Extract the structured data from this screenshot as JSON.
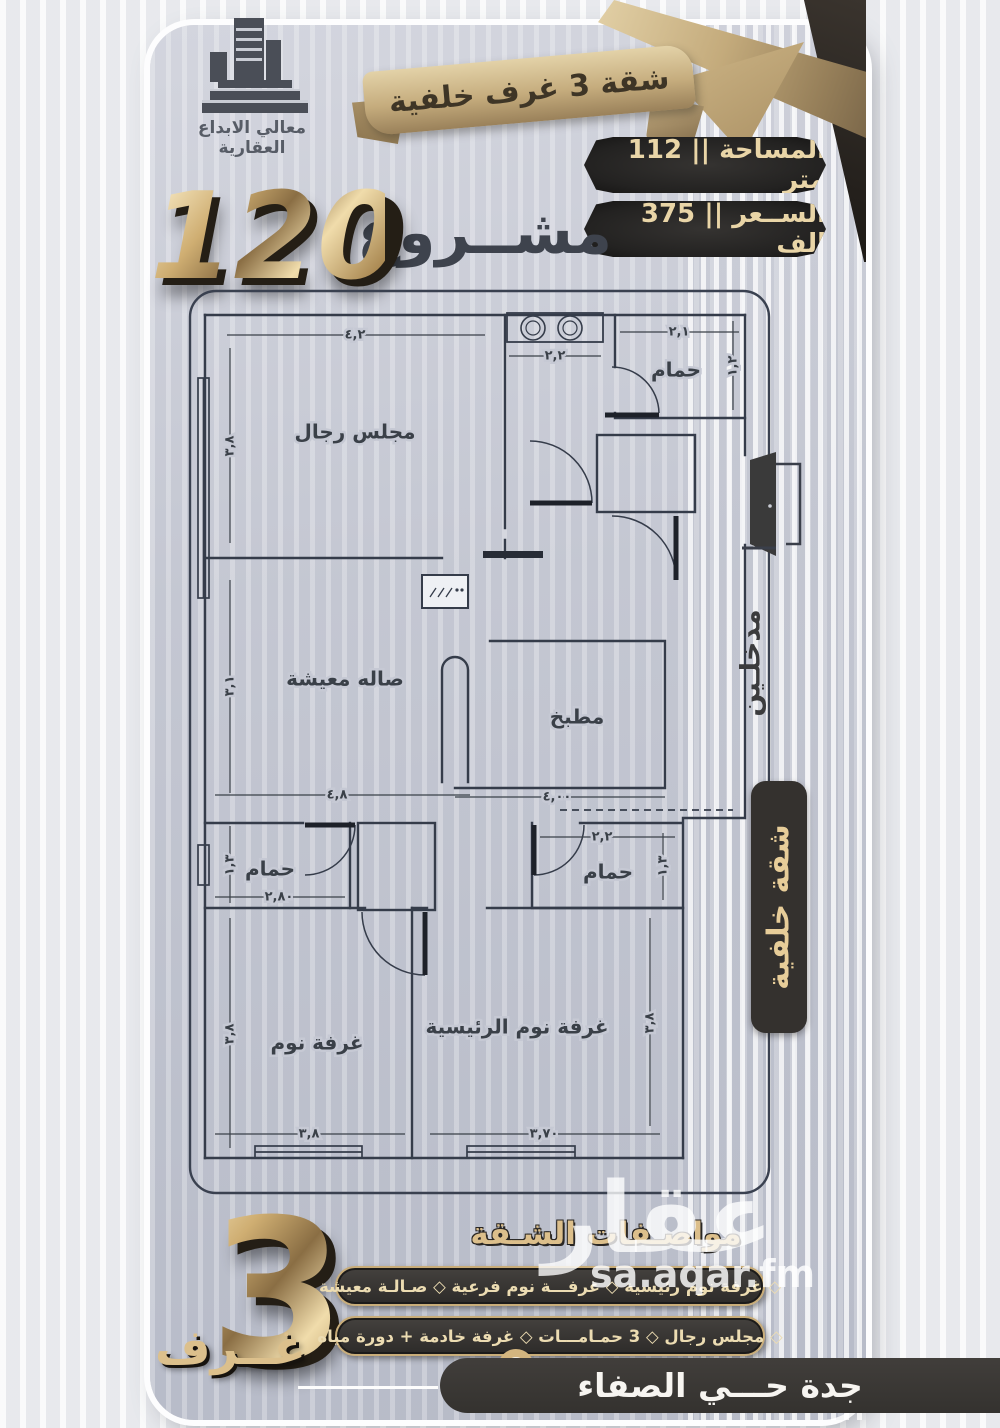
{
  "company": {
    "name": "معالي الابداع العقارية"
  },
  "ribbon": {
    "text": "شقة 3 غرف خلفية"
  },
  "stats": {
    "area": "المساحة || 112 متر",
    "price": "الســعر || 375 الف"
  },
  "project": {
    "word": "مشــروع",
    "number": "120"
  },
  "plan": {
    "rooms": {
      "majlis": "مجلس رجال",
      "bath_top": "حمام",
      "living": "صاله معيشة",
      "kitchen": "مطبخ",
      "bath_left": "حمام",
      "bath_right": "حمام",
      "bedroom": "غرفة نوم",
      "master": "غرفة نوم الرئيسية"
    },
    "dims": {
      "majlis_top": "٤,٢",
      "majlis_side": "٣,٨",
      "basin": "٢,٢",
      "bath_top_w": "٢,١",
      "bath_top_h": "١,٢",
      "living_side": "٣,١",
      "living_bottom": "٤,٨",
      "kitchen_bottom": "٤,٠٠",
      "bath_left_side": "١,٣",
      "bath_left_bottom": "٢,٨٠",
      "bath_right_top": "٢,٢",
      "bath_right_side": "١,٣",
      "bedroom_side": "٣,٨",
      "bedroom_bottom": "٣,٨",
      "master_bottom": "٣,٧٠",
      "master_side": "٣,٨"
    }
  },
  "side": {
    "entrances": "مدخلـين",
    "badge": "شقة خلفية"
  },
  "highlight": {
    "number": "3",
    "label": "غــرف"
  },
  "specs": {
    "title": "مواصـفات الشـقة",
    "row1": "◇  غرفة نوم رئيسية    ◇  غرفـــة نوم فرعية    ◇  صـالـة معيشة",
    "row2": "◇  مجلس رجال    ◇  3 حمـامـــات    ◇  غرفة خادمة + دورة مياه"
  },
  "footer": {
    "location": "جدة حـــي الصفاء"
  },
  "watermark": {
    "name": "عقار",
    "domain": "sa.aqar.fm"
  },
  "colors": {
    "gold": "#d9bd8a",
    "gold_dark": "#8d744c",
    "pill_bg": "#2a2928",
    "bar_dark": "#3a3836",
    "ink": "#3d424d",
    "cream": "#ecd9ae"
  }
}
